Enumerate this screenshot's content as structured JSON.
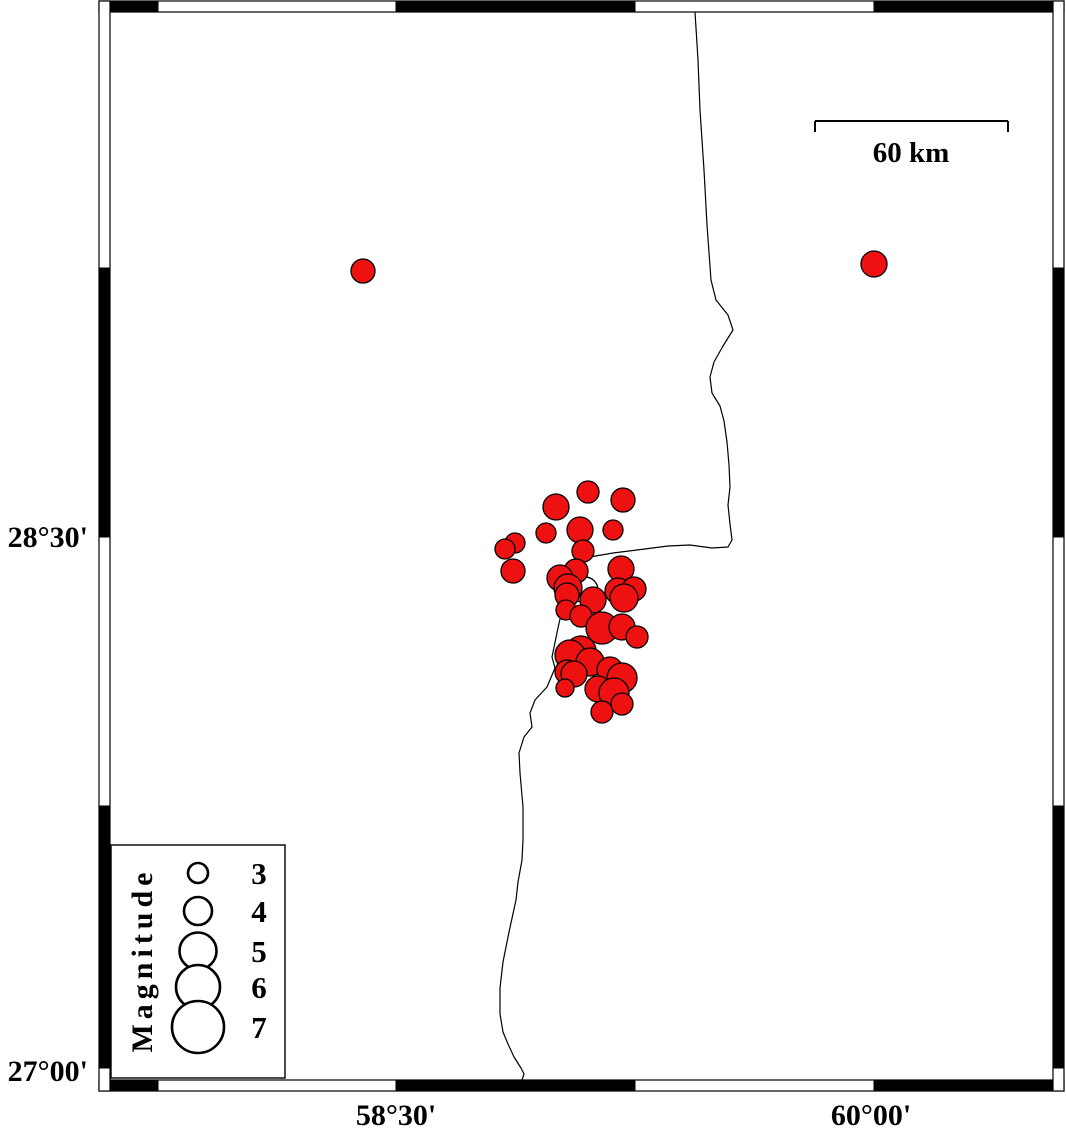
{
  "figure": {
    "type": "earthquake-epicenter-map",
    "background": "#ffffff",
    "frame_color": "#000000",
    "marker_color": "#ee1111",
    "marker_outline": "#000000"
  },
  "axes": {
    "left_labels": [
      {
        "text": "28°30'",
        "y": 537
      },
      {
        "text": "27°00'",
        "y": 1071
      }
    ],
    "bottom_labels": [
      {
        "text": "58°30'",
        "x": 396
      },
      {
        "text": "60°00'",
        "x": 871
      }
    ]
  },
  "frame": {
    "inner": [
      110,
      12,
      1053,
      1080
    ],
    "thickness": 11,
    "h_black": [
      [
        110,
        158
      ],
      [
        396,
        635
      ],
      [
        874,
        1053
      ]
    ],
    "v_black": [
      [
        268,
        537
      ],
      [
        806,
        1068
      ]
    ]
  },
  "scalebar": {
    "label": "60 km",
    "x1": 815,
    "x2": 1008,
    "y": 121,
    "tick_drop": 11
  },
  "legend": {
    "title": "Magnitude",
    "box": [
      111,
      845,
      285,
      1078
    ],
    "symbol_cx": 198,
    "label_x": 259,
    "entries": [
      {
        "magnitude": "3",
        "radius": 10,
        "cy": 873
      },
      {
        "magnitude": "4",
        "radius": 14,
        "cy": 911
      },
      {
        "magnitude": "5",
        "radius": 18.5,
        "cy": 951
      },
      {
        "magnitude": "6",
        "radius": 22,
        "cy": 987
      },
      {
        "magnitude": "7",
        "radius": 26,
        "cy": 1027
      }
    ]
  },
  "map": {
    "open_marker": {
      "x": 585,
      "y": 590,
      "r": 13
    },
    "epicenters": [
      {
        "x": 363,
        "y": 271,
        "r": 12
      },
      {
        "x": 874,
        "y": 264,
        "r": 13
      },
      {
        "x": 588,
        "y": 492,
        "r": 11
      },
      {
        "x": 623,
        "y": 500,
        "r": 12
      },
      {
        "x": 556,
        "y": 507,
        "r": 13
      },
      {
        "x": 580,
        "y": 530,
        "r": 13
      },
      {
        "x": 613,
        "y": 530,
        "r": 10
      },
      {
        "x": 546,
        "y": 533,
        "r": 10
      },
      {
        "x": 515,
        "y": 543,
        "r": 10
      },
      {
        "x": 505,
        "y": 549,
        "r": 10
      },
      {
        "x": 513,
        "y": 571,
        "r": 12
      },
      {
        "x": 583,
        "y": 551,
        "r": 11
      },
      {
        "x": 576,
        "y": 571,
        "r": 12
      },
      {
        "x": 560,
        "y": 578,
        "r": 13
      },
      {
        "x": 568,
        "y": 588,
        "r": 14
      },
      {
        "x": 621,
        "y": 569,
        "r": 13
      },
      {
        "x": 618,
        "y": 591,
        "r": 13
      },
      {
        "x": 634,
        "y": 589,
        "r": 12
      },
      {
        "x": 567,
        "y": 595,
        "r": 12
      },
      {
        "x": 593,
        "y": 600,
        "r": 13
      },
      {
        "x": 624,
        "y": 598,
        "r": 14
      },
      {
        "x": 566,
        "y": 610,
        "r": 10
      },
      {
        "x": 581,
        "y": 616,
        "r": 11
      },
      {
        "x": 602,
        "y": 628,
        "r": 16
      },
      {
        "x": 622,
        "y": 627,
        "r": 13
      },
      {
        "x": 637,
        "y": 637,
        "r": 11
      },
      {
        "x": 581,
        "y": 651,
        "r": 15
      },
      {
        "x": 570,
        "y": 655,
        "r": 15
      },
      {
        "x": 590,
        "y": 662,
        "r": 14
      },
      {
        "x": 567,
        "y": 672,
        "r": 12
      },
      {
        "x": 574,
        "y": 674,
        "r": 13
      },
      {
        "x": 610,
        "y": 670,
        "r": 13
      },
      {
        "x": 622,
        "y": 678,
        "r": 15
      },
      {
        "x": 565,
        "y": 688,
        "r": 9
      },
      {
        "x": 598,
        "y": 689,
        "r": 13
      },
      {
        "x": 614,
        "y": 693,
        "r": 15
      },
      {
        "x": 602,
        "y": 712,
        "r": 11
      },
      {
        "x": 622,
        "y": 704,
        "r": 11
      }
    ],
    "river_path": [
      [
        695,
        12
      ],
      [
        698,
        60
      ],
      [
        700,
        110
      ],
      [
        704,
        170
      ],
      [
        707,
        225
      ],
      [
        711,
        280
      ],
      [
        716,
        300
      ],
      [
        728,
        315
      ],
      [
        733,
        330
      ],
      [
        723,
        346
      ],
      [
        714,
        362
      ],
      [
        710,
        377
      ],
      [
        712,
        393
      ],
      [
        720,
        406
      ],
      [
        724,
        421
      ],
      [
        727,
        442
      ],
      [
        729,
        465
      ],
      [
        730,
        487
      ],
      [
        728,
        505
      ],
      [
        730,
        524
      ],
      [
        732,
        540
      ],
      [
        728,
        547
      ],
      [
        712,
        548
      ],
      [
        690,
        545
      ],
      [
        668,
        546
      ],
      [
        637,
        550
      ],
      [
        613,
        553
      ],
      [
        590,
        557
      ],
      [
        576,
        566
      ],
      [
        566,
        592
      ],
      [
        558,
        628
      ],
      [
        552,
        657
      ],
      [
        555,
        668
      ],
      [
        547,
        687
      ],
      [
        535,
        700
      ],
      [
        530,
        713
      ],
      [
        532,
        727
      ],
      [
        524,
        737
      ],
      [
        519,
        753
      ],
      [
        520,
        773
      ],
      [
        523,
        807
      ],
      [
        523,
        840
      ],
      [
        522,
        860
      ],
      [
        518,
        882
      ],
      [
        516,
        900
      ],
      [
        509,
        932
      ],
      [
        503,
        962
      ],
      [
        500,
        988
      ],
      [
        500,
        1014
      ],
      [
        503,
        1032
      ],
      [
        508,
        1044
      ],
      [
        514,
        1057
      ],
      [
        521,
        1068
      ],
      [
        524,
        1074
      ],
      [
        522,
        1080
      ]
    ]
  }
}
